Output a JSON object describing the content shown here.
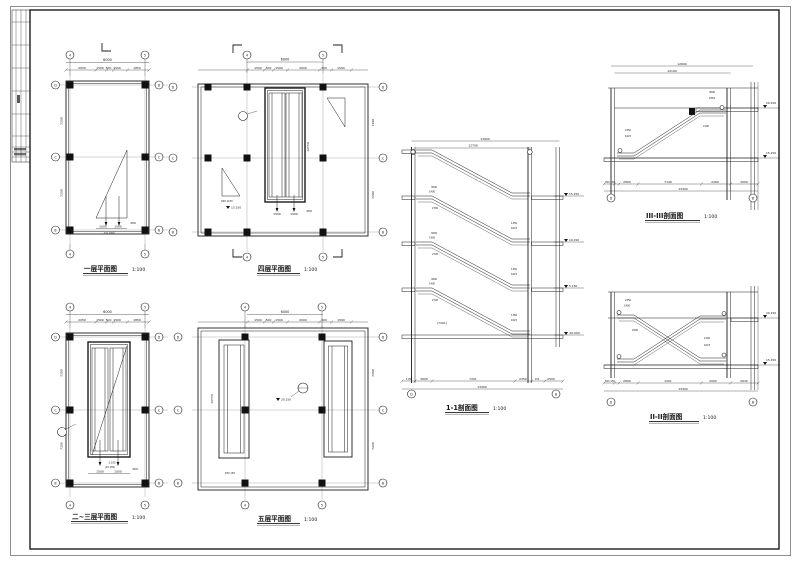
{
  "sheet": {
    "bg": "#ffffff",
    "line_color": "#1c1c1c"
  },
  "axes": {
    "col_a": "4",
    "col_b": "5",
    "row_top": "D",
    "row_mid": "C",
    "row_bot": "B",
    "sec_left": "D",
    "sec_right": "B"
  },
  "plans": {
    "first_floor": {
      "title": "一层平面图",
      "scale": "1:100",
      "total_width": "6000",
      "top_segs": [
        "2050",
        "1500",
        "500",
        "1500",
        "1850"
      ],
      "bay_depth": "7200",
      "esc": [
        "1500",
        "1500",
        "300"
      ],
      "level": "±0.000"
    },
    "fourth_floor": {
      "title": "四层平面图",
      "scale": "1:100",
      "total_width": "6000",
      "top_segs": [
        "1500",
        "500",
        "1500",
        "2000",
        "300",
        "1500"
      ],
      "bay_depth": "7200",
      "shaft_len": "12550",
      "esc": [
        "1500",
        "1500",
        "300"
      ],
      "level": "15.150",
      "stair": "600 1150"
    },
    "second_third_floor": {
      "title": "二~三层平面图",
      "scale": "1:100",
      "total_width": "6000",
      "top_segs": [
        "2050",
        "1500",
        "500",
        "1500",
        "1850"
      ],
      "bay_depth": "7200",
      "esc": [
        "1500",
        "1500",
        "300"
      ],
      "level": "5.150",
      "level2": "(10.150)"
    },
    "fifth_floor": {
      "title": "五层平面图",
      "scale": "1:100",
      "total_width": "6000",
      "top_segs": [
        "1500",
        "500",
        "1500",
        "2000",
        "300",
        "1500"
      ],
      "bay_depth": "7200",
      "shaft_len": "12550",
      "level": "20.150",
      "small": "650 150"
    }
  },
  "sections": {
    "s1": {
      "title": "1-1剖面图",
      "scale": "1:100",
      "top_total": "13900",
      "top_inner": "12790",
      "bottom_segs": [
        "1150",
        "3000",
        "7201",
        "2350",
        "150",
        "2500"
      ],
      "bottom_total": "13400",
      "levels": [
        "15.150",
        "10.150",
        "5.150",
        "±0.000"
      ],
      "left_dims": [
        "3000",
        "1400",
        "2700"
      ],
      "right_dims": [
        "1350",
        "1623"
      ],
      "center_note": "(7201)"
    },
    "s3": {
      "title": "III-III剖面图",
      "scale": "1:100",
      "top_total": "12900",
      "top_inner": "12190",
      "bottom_small": "300 150",
      "bottom_segs": [
        "2800",
        "7140",
        "2260",
        "3000"
      ],
      "bottom_total": "13400",
      "level_hi": "20.150",
      "level_lo": "15.150",
      "dims": [
        "2350",
        "1623",
        "3600",
        "1663",
        "2100"
      ]
    },
    "s2": {
      "title": "II-II剖面图",
      "scale": "1:100",
      "bottom_small": "500 150",
      "bottom_segs": [
        "2800",
        "1201",
        "2000",
        "2630"
      ],
      "bottom_total": "13400",
      "level_hi": "20.150",
      "level_lo": "15.150",
      "dims": [
        "2350",
        "1400",
        "2500",
        "2100",
        "1623"
      ]
    }
  }
}
